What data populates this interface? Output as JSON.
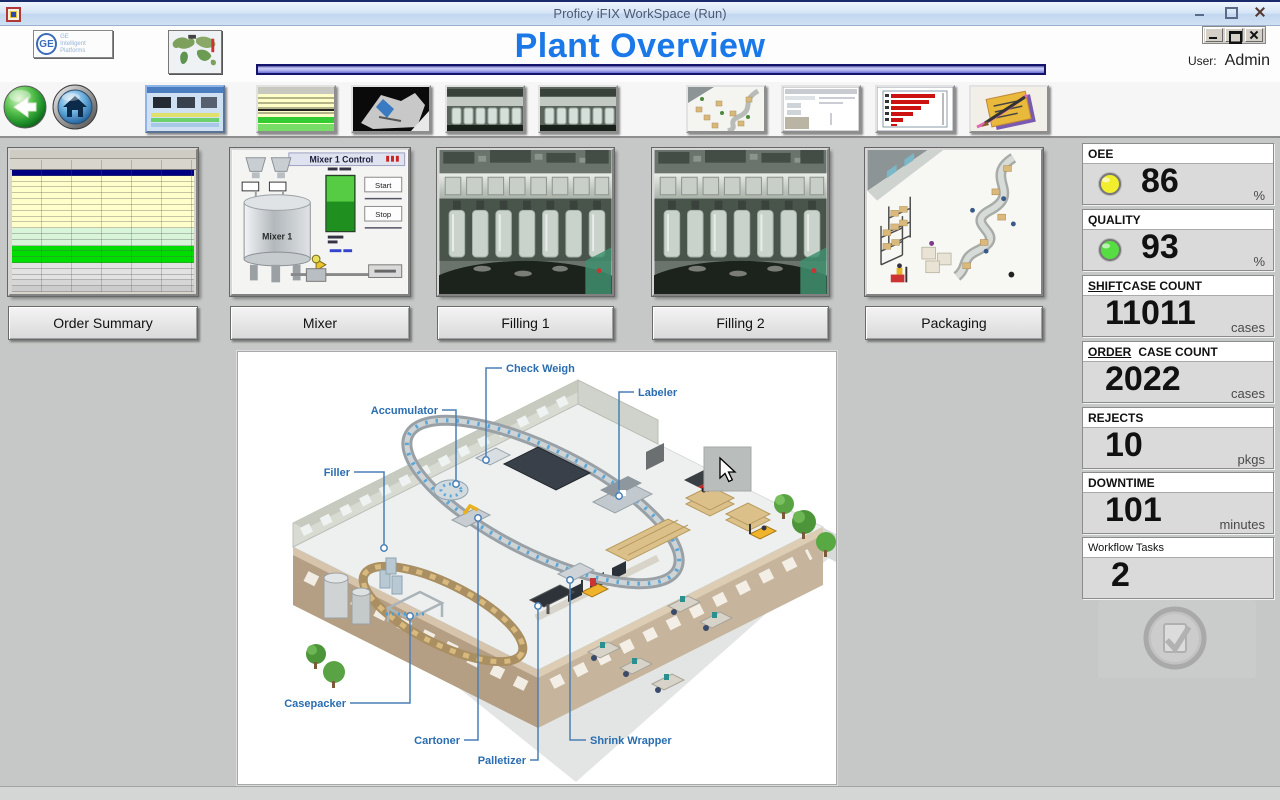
{
  "window": {
    "title": "Proficy iFIX WorkSpace (Run)"
  },
  "header": {
    "logo_line1": "GE",
    "logo_line2": "Intelligent Platforms",
    "page_title": "Plant Overview",
    "user_label": "User:",
    "user_name": "Admin"
  },
  "stations": [
    {
      "label": "Order Summary"
    },
    {
      "label": "Mixer"
    },
    {
      "label": "Filling 1"
    },
    {
      "label": "Filling 2"
    },
    {
      "label": "Packaging"
    }
  ],
  "mixer_panel": {
    "title": "Mixer 1 Control",
    "tank_label": "Mixer 1",
    "start_label": "Start",
    "stop_label": "Stop"
  },
  "order_table": {
    "row_colors": [
      "#000080",
      "#ffffcc",
      "#ffffcc",
      "#ffffcc",
      "#ffffcc",
      "#ffffcc",
      "#ffffcc",
      "#ffffcc",
      "#ffffcc",
      "#ffffcc",
      "#d9f5d9",
      "#d9f5d9",
      "#d9f5d9",
      "#00dd00",
      "#00dd00",
      "#00dd00",
      "#e2e2e2",
      "#e2e2e2",
      "#e2e2e2",
      "#d6d6d6",
      "#cccccc"
    ]
  },
  "diagram": {
    "labels": {
      "filler": "Filler",
      "accumulator": "Accumulator",
      "check_weigh": "Check Weigh",
      "labeler": "Labeler",
      "casepacker": "Casepacker",
      "cartoner": "Cartoner",
      "palletizer": "Palletizer",
      "shrink_wrapper": "Shrink Wrapper"
    }
  },
  "kpis": [
    {
      "prefix": "",
      "label": "OEE",
      "value": "86",
      "unit": "%",
      "led": "#f2ee2e"
    },
    {
      "prefix": "",
      "label": "QUALITY",
      "value": "93",
      "unit": "%",
      "led": "#55dd41"
    },
    {
      "prefix": "SHIFT",
      "label": "CASE COUNT",
      "value": "11011",
      "unit": "cases",
      "led": ""
    },
    {
      "prefix": "ORDER",
      "label": "CASE COUNT",
      "value": "2022",
      "unit": "cases",
      "led": ""
    },
    {
      "prefix": "",
      "label": "REJECTS",
      "value": "10",
      "unit": "pkgs",
      "led": ""
    },
    {
      "prefix": "",
      "label": "DOWNTIME",
      "value": "101",
      "unit": "minutes",
      "led": ""
    },
    {
      "prefix": "",
      "label": "Workflow Tasks",
      "value": "2",
      "unit": "",
      "led": ""
    }
  ]
}
